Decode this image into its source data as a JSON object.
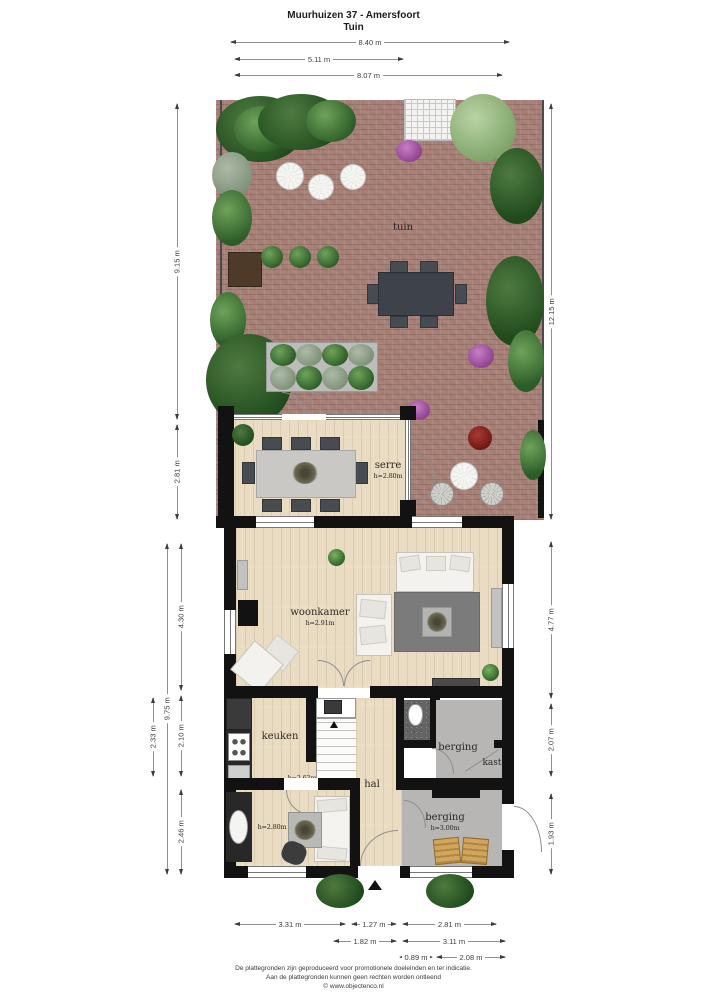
{
  "header": {
    "title": "Muurhuizen 37 - Amersfoort",
    "subtitle": "Tuin"
  },
  "dimensions": {
    "top": [
      {
        "label": "8.40 m"
      },
      {
        "label": "5.11 m"
      },
      {
        "label": "8.07 m"
      }
    ],
    "left": [
      {
        "label": "9.15 m"
      },
      {
        "label": "2.81 m"
      },
      {
        "label": "4.30 m"
      },
      {
        "label": "2.10 m"
      },
      {
        "label": "2.46 m"
      },
      {
        "label": "9.75 m"
      },
      {
        "label": "2.33 m"
      }
    ],
    "right": [
      {
        "label": "12.15 m"
      },
      {
        "label": "4.77 m"
      },
      {
        "label": "2.07 m"
      },
      {
        "label": "1.93 m"
      }
    ],
    "bottom": [
      {
        "label": "3.31 m"
      },
      {
        "label": "1.27 m"
      },
      {
        "label": "2.81 m"
      },
      {
        "label": "1.82 m"
      },
      {
        "label": "3.11 m"
      },
      {
        "label": "0.89 m"
      },
      {
        "label": "2.08 m"
      }
    ]
  },
  "rooms": {
    "tuin": {
      "name": "tuin"
    },
    "serre": {
      "name": "serre",
      "ceiling": "h=2.80m"
    },
    "woonkamer": {
      "name": "woonkamer",
      "ceiling": "h=2.91m"
    },
    "keuken": {
      "name": "keuken",
      "ceiling": "h=2.62m"
    },
    "hal": {
      "name": "hal"
    },
    "berging_mid": {
      "name": "berging"
    },
    "kast": {
      "name": "kast"
    },
    "kamer": {
      "ceiling": "h=2.80m"
    },
    "berging_onder": {
      "name": "berging",
      "ceiling": "h=3.00m"
    }
  },
  "footer": {
    "line1": "De plattegronden zijn geproduceerd voor promotionele doeleinden en ter indicatie.",
    "line2": "Aan de plattegronden kunnen geen rechten worden ontleend",
    "line3": "© www.objectenco.nl"
  },
  "colors": {
    "wall": "#121212",
    "brick_patio": "#a9837a",
    "wood_floor": "#e9dcc2",
    "storage_floor": "#b7b6b4",
    "foliage_dark": "#1f4a1c",
    "foliage_light": "#7da368",
    "accent_purple": "#8e3f8c",
    "accent_tan": "#d2a55a"
  }
}
